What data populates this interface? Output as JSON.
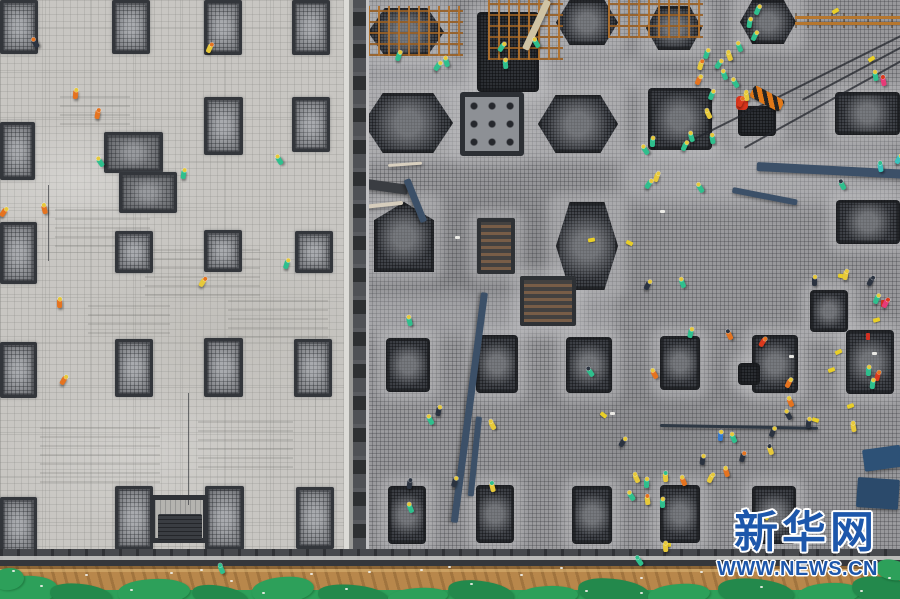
{
  "watermark": {
    "brand": "新华网",
    "url": "WWW.NEWS.CN",
    "text_color": "#1d57ab",
    "outline_color": "#ffffff"
  },
  "palette": {
    "left_slab": "#c8c6c2",
    "right_slab": "#98989b",
    "pad_dark": "#34373c",
    "pad_fill": "#8e9196",
    "divider_dark": "#4f5155",
    "divider_light": "#dcdbd7",
    "soil": "#b8874b",
    "tarp_green": "#2da05a",
    "tarp_green_dark": "#23894c",
    "edge_dark": "#47494d",
    "beam_blue": "#3c5068",
    "rust": "#ad6e2a",
    "marker_yellow": "#e9cf28",
    "vest": {
      "g": "#2fbf8d",
      "y": "#e7c93a",
      "o": "#e5731f",
      "r": "#da391c",
      "n": "#2b3340",
      "b": "#3579cf",
      "c": "#3ac3bd",
      "p": "#e73a77"
    }
  },
  "scene": {
    "left_pads": [
      [
        0,
        0,
        38,
        54
      ],
      [
        112,
        0,
        38,
        54
      ],
      [
        204,
        0,
        38,
        55
      ],
      [
        292,
        0,
        38,
        55
      ],
      [
        0,
        122,
        35,
        58
      ],
      [
        204,
        97,
        39,
        58
      ],
      [
        292,
        97,
        38,
        55
      ],
      [
        0,
        222,
        37,
        62
      ],
      [
        115,
        231,
        38,
        42
      ],
      [
        204,
        230,
        38,
        42
      ],
      [
        295,
        231,
        38,
        42
      ],
      [
        0,
        342,
        37,
        56
      ],
      [
        115,
        339,
        38,
        58
      ],
      [
        204,
        338,
        39,
        59
      ],
      [
        294,
        339,
        38,
        58
      ],
      [
        0,
        497,
        37,
        58
      ],
      [
        115,
        486,
        38,
        64
      ],
      [
        205,
        486,
        39,
        64
      ],
      [
        296,
        487,
        38,
        62
      ]
    ],
    "cluster_pads": [
      [
        104,
        132,
        59,
        41
      ],
      [
        119,
        172,
        58,
        41
      ]
    ],
    "left_pit_frame": [
      150,
      495,
      58,
      48
    ],
    "left_pit_inner": [
      158,
      514,
      44,
      26
    ],
    "right_pads": [
      [
        368,
        8,
        76,
        48,
        "hex"
      ],
      [
        477,
        12,
        62,
        80,
        "dark"
      ],
      [
        556,
        0,
        62,
        45,
        "hex"
      ],
      [
        646,
        6,
        56,
        44,
        "hex"
      ],
      [
        740,
        0,
        56,
        44,
        "hex"
      ],
      [
        363,
        93,
        90,
        60,
        "hex"
      ],
      [
        460,
        92,
        64,
        64,
        "sq"
      ],
      [
        538,
        95,
        80,
        58,
        "hex"
      ],
      [
        648,
        88,
        64,
        62,
        "rect"
      ],
      [
        738,
        106,
        38,
        30,
        "dark"
      ],
      [
        835,
        92,
        65,
        43,
        "rect"
      ],
      [
        374,
        202,
        60,
        70,
        "penta"
      ],
      [
        477,
        218,
        38,
        56,
        "frame"
      ],
      [
        556,
        202,
        62,
        88,
        "hex"
      ],
      [
        836,
        200,
        64,
        44,
        "rect"
      ],
      [
        520,
        276,
        56,
        50,
        "frame"
      ],
      [
        386,
        338,
        44,
        54,
        "rect"
      ],
      [
        476,
        335,
        42,
        58,
        "rect"
      ],
      [
        566,
        337,
        46,
        56,
        "rect"
      ],
      [
        660,
        336,
        40,
        54,
        "rect"
      ],
      [
        752,
        335,
        46,
        58,
        "rect"
      ],
      [
        810,
        290,
        38,
        42,
        "rect"
      ],
      [
        846,
        330,
        48,
        64,
        "rect"
      ],
      [
        738,
        363,
        22,
        22,
        "dark"
      ],
      [
        388,
        486,
        38,
        58,
        "rect"
      ],
      [
        476,
        485,
        38,
        58,
        "rect"
      ],
      [
        572,
        486,
        40,
        58,
        "rect"
      ],
      [
        660,
        485,
        40,
        58,
        "rect"
      ],
      [
        752,
        486,
        44,
        58,
        "rect"
      ]
    ],
    "light_patches": [
      [
        363,
        55,
        285,
        38
      ],
      [
        618,
        148,
        282,
        56
      ],
      [
        363,
        293,
        255,
        45
      ]
    ],
    "chalk": [
      [
        55,
        205,
        95,
        42
      ],
      [
        145,
        248,
        115,
        48
      ],
      [
        40,
        425,
        120,
        58
      ],
      [
        198,
        418,
        95,
        50
      ],
      [
        88,
        298,
        82,
        36
      ],
      [
        228,
        298,
        100,
        40
      ],
      [
        60,
        95,
        70,
        30
      ]
    ],
    "scaffolds": [
      [
        368,
        6,
        95,
        50
      ],
      [
        488,
        0,
        75,
        60
      ],
      [
        608,
        0,
        95,
        38
      ]
    ],
    "rust_bar": [
      795,
      13,
      105,
      15
    ],
    "tiger": [
      750,
      92,
      34,
      13,
      28
    ],
    "red_blob": [
      736,
      96,
      12,
      14
    ],
    "beams": [
      [
        410,
        178,
        46,
        7,
        68,
        "#3c5068"
      ],
      [
        488,
        293,
        232,
        7,
        97.5,
        "#3c5068"
      ],
      [
        482,
        417,
        80,
        6,
        96,
        "#3c5068"
      ],
      [
        757,
        162,
        146,
        9,
        3,
        "#3c5068"
      ],
      [
        733,
        187,
        66,
        6,
        11,
        "#3c5068"
      ],
      [
        660,
        424,
        158,
        3,
        1,
        "#2e3844"
      ],
      [
        862,
        450,
        38,
        22,
        -8,
        "#2d5176"
      ],
      [
        858,
        477,
        42,
        30,
        4,
        "#2b4a6b"
      ]
    ],
    "planks": [
      [
        367,
        179,
        42,
        10,
        8,
        "#3a3d42"
      ],
      [
        522,
        48,
        54,
        7,
        -65,
        "#cfc3a4"
      ],
      [
        388,
        164,
        34,
        3,
        -4,
        "#d9d0bf"
      ],
      [
        363,
        205,
        40,
        4,
        -6,
        "#d6cdbc"
      ]
    ],
    "cables": [
      [
        688,
        141,
        242,
        -26.5
      ],
      [
        744,
        147,
        183,
        -29
      ],
      [
        802,
        99,
        116,
        -28
      ]
    ],
    "wires": [
      [
        48,
        185,
        76
      ],
      [
        188,
        393,
        112
      ]
    ],
    "markers": [
      [
        626,
        241
      ],
      [
        838,
        274
      ],
      [
        873,
        318
      ],
      [
        835,
        350
      ],
      [
        828,
        368
      ],
      [
        847,
        404
      ],
      [
        812,
        418
      ],
      [
        664,
        543
      ],
      [
        600,
        413
      ],
      [
        762,
        515
      ],
      [
        832,
        9
      ],
      [
        868,
        57
      ],
      [
        588,
        238
      ],
      [
        349,
        332
      ]
    ],
    "red_dots": [
      [
        866,
        333
      ],
      [
        881,
        300
      ],
      [
        349,
        359
      ]
    ],
    "white_bits": [
      [
        455,
        236
      ],
      [
        872,
        352
      ],
      [
        660,
        210
      ],
      [
        610,
        412
      ],
      [
        789,
        355
      ]
    ],
    "workers": [
      [
        33,
        39,
        "n",
        "o"
      ],
      [
        207,
        44,
        "y",
        "o"
      ],
      [
        73,
        90,
        "o",
        "y"
      ],
      [
        95,
        110,
        "o",
        "o"
      ],
      [
        98,
        158,
        "g",
        "y"
      ],
      [
        181,
        170,
        "g",
        "y"
      ],
      [
        277,
        156,
        "g",
        "y"
      ],
      [
        1,
        208,
        "o",
        "y"
      ],
      [
        42,
        205,
        "o",
        "y"
      ],
      [
        284,
        260,
        "g",
        "y"
      ],
      [
        200,
        278,
        "y",
        "o"
      ],
      [
        57,
        299,
        "o",
        "y"
      ],
      [
        61,
        376,
        "o",
        "y"
      ],
      [
        219,
        565,
        "g",
        "g"
      ],
      [
        396,
        52,
        "g",
        "y"
      ],
      [
        444,
        58,
        "g",
        "y"
      ],
      [
        499,
        43,
        "g",
        "y"
      ],
      [
        534,
        39,
        "g",
        "y"
      ],
      [
        503,
        60,
        "g",
        "y"
      ],
      [
        435,
        62,
        "g",
        "y"
      ],
      [
        755,
        6,
        "g",
        "y"
      ],
      [
        747,
        19,
        "g",
        "y"
      ],
      [
        752,
        32,
        "g",
        "y"
      ],
      [
        737,
        43,
        "g",
        "y"
      ],
      [
        727,
        52,
        "y",
        "y"
      ],
      [
        716,
        60,
        "g",
        "y"
      ],
      [
        704,
        50,
        "g",
        "y"
      ],
      [
        698,
        61,
        "y",
        "o"
      ],
      [
        722,
        71,
        "g",
        "y"
      ],
      [
        696,
        76,
        "o",
        "y"
      ],
      [
        709,
        91,
        "g",
        "y"
      ],
      [
        733,
        79,
        "g",
        "y"
      ],
      [
        744,
        92,
        "y",
        "y"
      ],
      [
        873,
        72,
        "g",
        "y"
      ],
      [
        881,
        77,
        "p",
        "r"
      ],
      [
        706,
        110,
        "y",
        "y"
      ],
      [
        738,
        98,
        "r",
        "o"
      ],
      [
        689,
        133,
        "g",
        "y"
      ],
      [
        682,
        142,
        "g",
        "y"
      ],
      [
        650,
        138,
        "g",
        "y"
      ],
      [
        643,
        146,
        "g",
        "y"
      ],
      [
        654,
        173,
        "y",
        "y"
      ],
      [
        646,
        180,
        "g",
        "y"
      ],
      [
        698,
        184,
        "g",
        "y"
      ],
      [
        710,
        135,
        "g",
        "y"
      ],
      [
        840,
        181,
        "g",
        "n"
      ],
      [
        878,
        163,
        "c",
        "g"
      ],
      [
        896,
        155,
        "c",
        "y"
      ],
      [
        812,
        277,
        "n",
        "y"
      ],
      [
        868,
        277,
        "n",
        "n"
      ],
      [
        407,
        317,
        "g",
        "y"
      ],
      [
        436,
        407,
        "n",
        "y"
      ],
      [
        428,
        416,
        "g",
        "y"
      ],
      [
        490,
        421,
        "y",
        "y"
      ],
      [
        452,
        478,
        "n",
        "y"
      ],
      [
        407,
        480,
        "n",
        "n"
      ],
      [
        490,
        483,
        "y",
        "g"
      ],
      [
        408,
        504,
        "g",
        "y"
      ],
      [
        588,
        368,
        "g",
        "n"
      ],
      [
        620,
        438,
        "n",
        "y"
      ],
      [
        680,
        279,
        "g",
        "y"
      ],
      [
        645,
        281,
        "n",
        "y"
      ],
      [
        688,
        329,
        "g",
        "y"
      ],
      [
        727,
        331,
        "o",
        "n"
      ],
      [
        760,
        338,
        "r",
        "o"
      ],
      [
        652,
        370,
        "o",
        "y"
      ],
      [
        786,
        379,
        "o",
        "y"
      ],
      [
        788,
        398,
        "o",
        "y"
      ],
      [
        786,
        411,
        "n",
        "y"
      ],
      [
        806,
        419,
        "n",
        "y"
      ],
      [
        770,
        428,
        "n",
        "y"
      ],
      [
        851,
        423,
        "y",
        "y"
      ],
      [
        718,
        432,
        "b",
        "y"
      ],
      [
        731,
        434,
        "g",
        "y"
      ],
      [
        768,
        446,
        "y",
        "n"
      ],
      [
        740,
        453,
        "n",
        "o"
      ],
      [
        700,
        456,
        "n",
        "y"
      ],
      [
        724,
        468,
        "o",
        "y"
      ],
      [
        663,
        473,
        "y",
        "g"
      ],
      [
        681,
        477,
        "o",
        "y"
      ],
      [
        644,
        479,
        "g",
        "y"
      ],
      [
        634,
        474,
        "y",
        "y"
      ],
      [
        629,
        492,
        "g",
        "y"
      ],
      [
        645,
        496,
        "y",
        "o"
      ],
      [
        660,
        499,
        "g",
        "y"
      ],
      [
        708,
        474,
        "y",
        "y"
      ],
      [
        874,
        295,
        "g",
        "y"
      ],
      [
        883,
        299,
        "p",
        "r"
      ],
      [
        843,
        271,
        "y",
        "y"
      ],
      [
        637,
        557,
        "g",
        "g"
      ],
      [
        663,
        543,
        "y",
        "y"
      ],
      [
        866,
        367,
        "g",
        "y"
      ],
      [
        875,
        372,
        "r",
        "o"
      ],
      [
        870,
        380,
        "g",
        "y"
      ]
    ],
    "tarp_blobs": [
      [
        -12,
        576,
        70,
        30,
        -6,
        1
      ],
      [
        50,
        584,
        62,
        22,
        5,
        2
      ],
      [
        118,
        579,
        72,
        26,
        -4,
        1
      ],
      [
        192,
        586,
        56,
        20,
        8,
        2
      ],
      [
        252,
        577,
        62,
        26,
        -7,
        1
      ],
      [
        318,
        585,
        70,
        22,
        4,
        2
      ],
      [
        388,
        588,
        60,
        18,
        -5,
        1
      ],
      [
        448,
        581,
        66,
        24,
        6,
        2
      ],
      [
        518,
        586,
        60,
        20,
        -4,
        1
      ],
      [
        578,
        579,
        72,
        26,
        5,
        2
      ],
      [
        648,
        584,
        62,
        22,
        -6,
        1
      ],
      [
        718,
        579,
        76,
        26,
        4,
        2
      ],
      [
        798,
        583,
        62,
        22,
        -5,
        1
      ],
      [
        852,
        577,
        62,
        26,
        6,
        2
      ],
      [
        876,
        560,
        34,
        20,
        10,
        1
      ],
      [
        -6,
        568,
        30,
        22,
        -10,
        1
      ]
    ],
    "debris": [
      [
        12,
        570
      ],
      [
        40,
        585
      ],
      [
        85,
        574
      ],
      [
        130,
        589
      ],
      [
        170,
        572
      ],
      [
        230,
        580
      ],
      [
        262,
        592
      ],
      [
        310,
        573
      ],
      [
        345,
        588
      ],
      [
        420,
        569
      ],
      [
        470,
        583
      ],
      [
        520,
        574
      ],
      [
        585,
        590
      ],
      [
        640,
        577
      ],
      [
        700,
        571
      ],
      [
        760,
        586
      ],
      [
        820,
        573
      ],
      [
        860,
        590
      ],
      [
        888,
        577
      ],
      [
        560,
        567
      ],
      [
        640,
        592
      ],
      [
        200,
        569
      ],
      [
        368,
        571
      ],
      [
        448,
        566
      ],
      [
        735,
        565
      ],
      [
        790,
        568
      ]
    ]
  }
}
